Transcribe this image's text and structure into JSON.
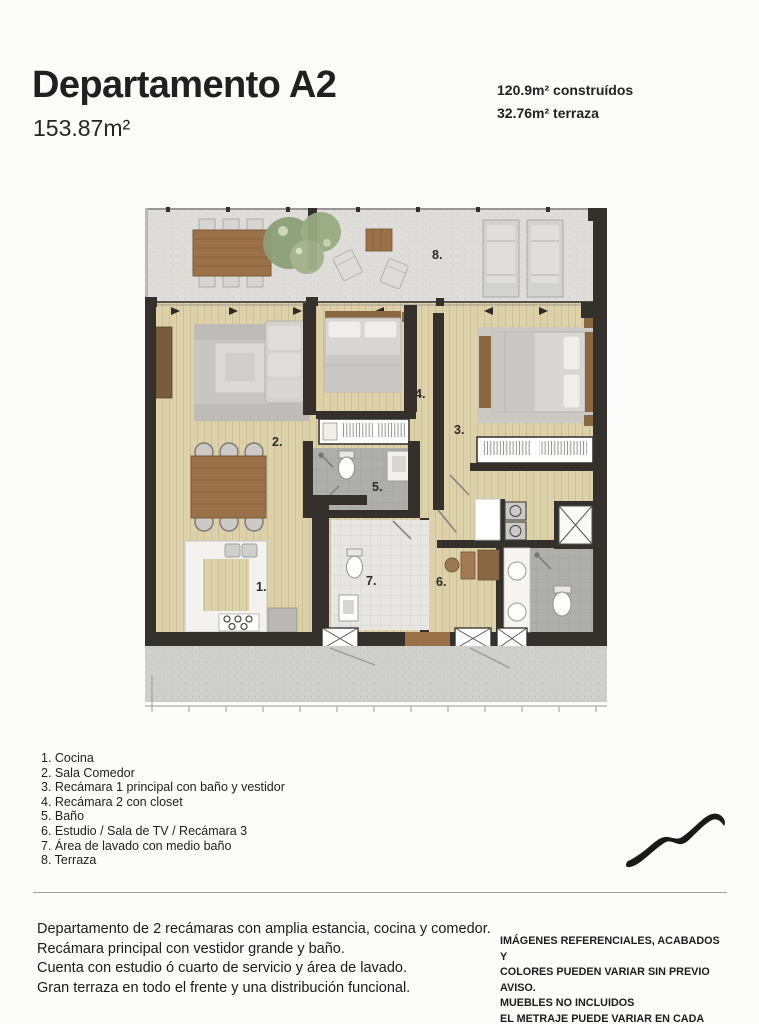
{
  "header": {
    "title": "Departamento A2",
    "total_area": "153.87m²",
    "built_area": "120.9m² construídos",
    "terrace_area": "32.76m² terraza"
  },
  "plan": {
    "room_numbers": [
      "1.",
      "2.",
      "3.",
      "4.",
      "5.",
      "6.",
      "7.",
      "8."
    ]
  },
  "legend": {
    "items": [
      "1. Cocina",
      "2. Sala Comedor",
      "3. Recámara 1 principal con baño y vestidor",
      "4. Recámara 2 con closet",
      "5. Baño",
      "6. Estudio / Sala de TV / Recámara 3",
      "7. Área de lavado con medio baño",
      "8. Terraza"
    ]
  },
  "description": {
    "lines": [
      "Departamento de 2 recámaras con amplia estancia, cocina y comedor.",
      "Recámara principal con vestidor grande y baño.",
      "Cuenta con estudio ó cuarto de servicio y área de lavado.",
      "Gran terraza en todo el frente y una distribución funcional."
    ]
  },
  "disclaimer": {
    "lines": [
      "IMÁGENES REFERENCIALES, ACABADOS Y",
      "COLORES PUEDEN VARIAR SIN PREVIO AVISO.",
      "MUEBLES NO INCLUIDOS",
      "EL METRAJE PUEDE VARIAR EN CADA NIVEL"
    ]
  },
  "colors": {
    "wall": "#34312d",
    "wood_floor": "#ded2ab",
    "terrace_floor": "#deddda",
    "concrete": "#cfcfcc",
    "bath_floor": "#aeaeab",
    "furniture_wood": "#9a7148",
    "rug": "#c7c6c3",
    "text": "#1e1e1e"
  },
  "icons": {
    "logo": "mountain-squiggle-logo"
  }
}
